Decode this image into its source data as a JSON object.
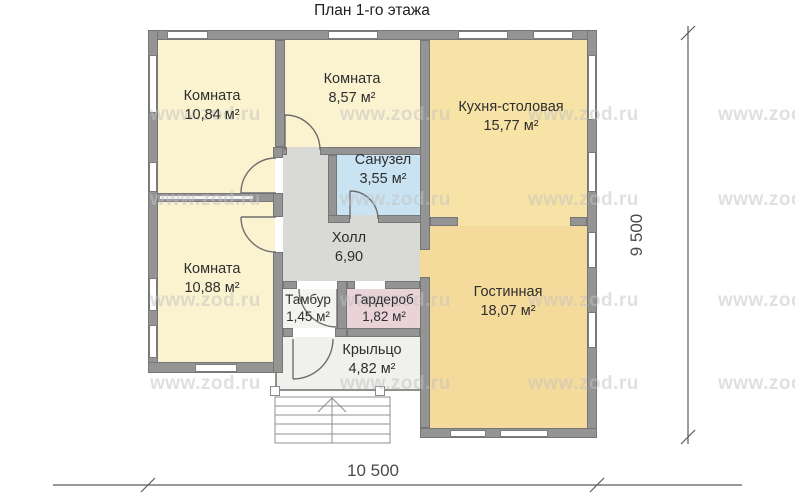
{
  "title": "План 1-го этажа",
  "watermark": "www.zod.ru",
  "dimensions": {
    "bottom": "10 500",
    "right": "9 500"
  },
  "rooms": {
    "room1": {
      "name": "Комната",
      "area": "10,84 м²"
    },
    "room2": {
      "name": "Комната",
      "area": "8,57 м²"
    },
    "kitchen": {
      "name": "Кухня-столовая",
      "area": "15,77 м²"
    },
    "bathroom": {
      "name": "Санузел",
      "area": "3,55 м²"
    },
    "hall": {
      "name": "Холл",
      "area": "6,90"
    },
    "room3": {
      "name": "Комната",
      "area": "10,88 м²"
    },
    "tambour": {
      "name": "Тамбур",
      "area": "1,45 м²"
    },
    "wardrobe": {
      "name": "Гардероб",
      "area": "1,82 м²"
    },
    "living": {
      "name": "Гостинная",
      "area": "18,07 м²"
    },
    "porch": {
      "name": "Крыльцо",
      "area": "4,82 м²"
    }
  },
  "colors": {
    "wall": "#949494",
    "wallBorder": "#767676",
    "creamRoom": "#FBF2D0",
    "kitchenFloor": "#F8E3A7",
    "livingFloor": "#F5DB9B",
    "bathFloor": "#C9E3F2",
    "hallFloor": "#D9D9D6",
    "tambourFloor": "#F3F3F0",
    "wardrobeFloor": "#E9D3D8",
    "porchFloor": "#F0F0ED",
    "line": "#6E6E6E",
    "dimension": "#4A4A4A",
    "label": "#2E2E2E",
    "watermarkColor": "#C2C2C2"
  }
}
